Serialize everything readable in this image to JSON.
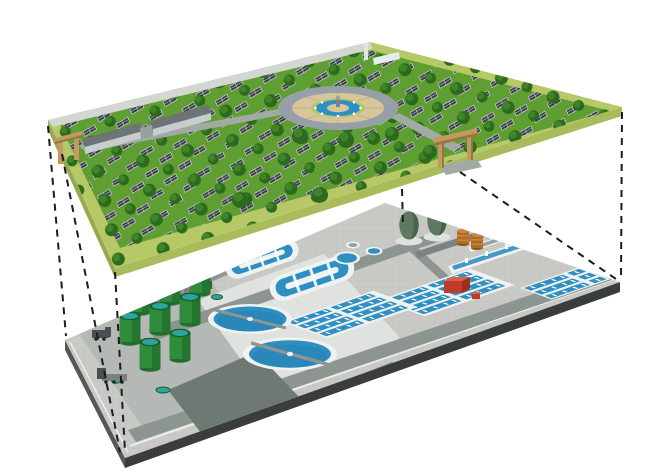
{
  "meta": {
    "description": "3D exploded-view rendering: a solar panel park built above an underground wastewater treatment plant, connected by dashed projection lines",
    "render_type": "architectural illustration, no visible text"
  },
  "colors": {
    "background": "#ffffff",
    "dash": "#1b1b1b",
    "grass": "#5f9e33",
    "grass_border": "#b7c967",
    "platform_side": "#a9bc5b",
    "platform_side_dark": "#96a94e",
    "tree": "#2d6a1e",
    "tree_hi": "#418a2a",
    "panel": "#383d49",
    "panel_line": "#e8e9ec",
    "path_light": "#d3d6d1",
    "road_green_top": "#a2aaa4",
    "bldg_roof": "#6d7377",
    "bldg_wall": "#c7ccce",
    "bldg_white": "#e6ebeb",
    "tower": "#dfe5e6",
    "gate": "#c09a5e",
    "gate_dark": "#97763f",
    "plaza_ring": "#97a0a6",
    "plaza_pave": "#d7c69b",
    "plaza_pave_line": "#c4b184",
    "ring_green": "#b4c868",
    "water": "#2e8fc2",
    "water_deep": "#1f6f9e",
    "white": "#f0f2f1",
    "plant_pave": "#c9cac6",
    "plant_pave_line": "#c0c1bd",
    "plant_road": "#8d9591",
    "plant_apron": "#b5b9b5",
    "plant_pad": "#dfe2de",
    "plant_patch": "#6e7973",
    "plant_side": "#393d3b",
    "plant_side_light": "#545856",
    "plant_curb": "#ebeeec",
    "tank_green": "#2e8c3a",
    "tank_green_dark": "#226e2c",
    "tank_rim": "#1c5f26",
    "tank_top": "#2aa5a0",
    "egg": "#5d7962",
    "egg_dark": "#445c49",
    "metal_dark": "#4a4f52",
    "metal_mid": "#7c8283",
    "metal_light": "#9aa0a0",
    "orange": "#b06a21",
    "orange_hi": "#c9883e",
    "orange_dark": "#8f5418",
    "red": "#c23b2a",
    "red_hi": "#d8604c",
    "red_dark": "#9c2f20"
  },
  "scene": {
    "upper_layer": {
      "name": "solar-park-platform",
      "features": [
        "solar-panel-arrays",
        "trees",
        "central-fountain-plaza",
        "observation-tower",
        "service-buildings",
        "entrance-gates",
        "pathways"
      ],
      "entrance_gates": 2,
      "service_buildings": 2,
      "towers": 1,
      "fountains": 1
    },
    "lower_layer": {
      "name": "wastewater-treatment-plant-platform",
      "features": [
        "oxidation-ditches",
        "secondary-clarifiers",
        "aeration-basins",
        "sludge-digester-tanks",
        "egg-shaped-digesters",
        "storage-tanks",
        "pump-buildings",
        "service-trucks",
        "dome-tank"
      ],
      "oxidation_ditches": 3,
      "secondary_clarifiers": 2,
      "aeration_basin_blocks": 3,
      "green_digester_tanks": 8,
      "egg_digesters": 2,
      "orange_tanks": 2,
      "red_buildings": 2,
      "trucks": 2
    },
    "connectors": {
      "style": "black dashed projection lines between layer corners",
      "count": 6
    }
  }
}
